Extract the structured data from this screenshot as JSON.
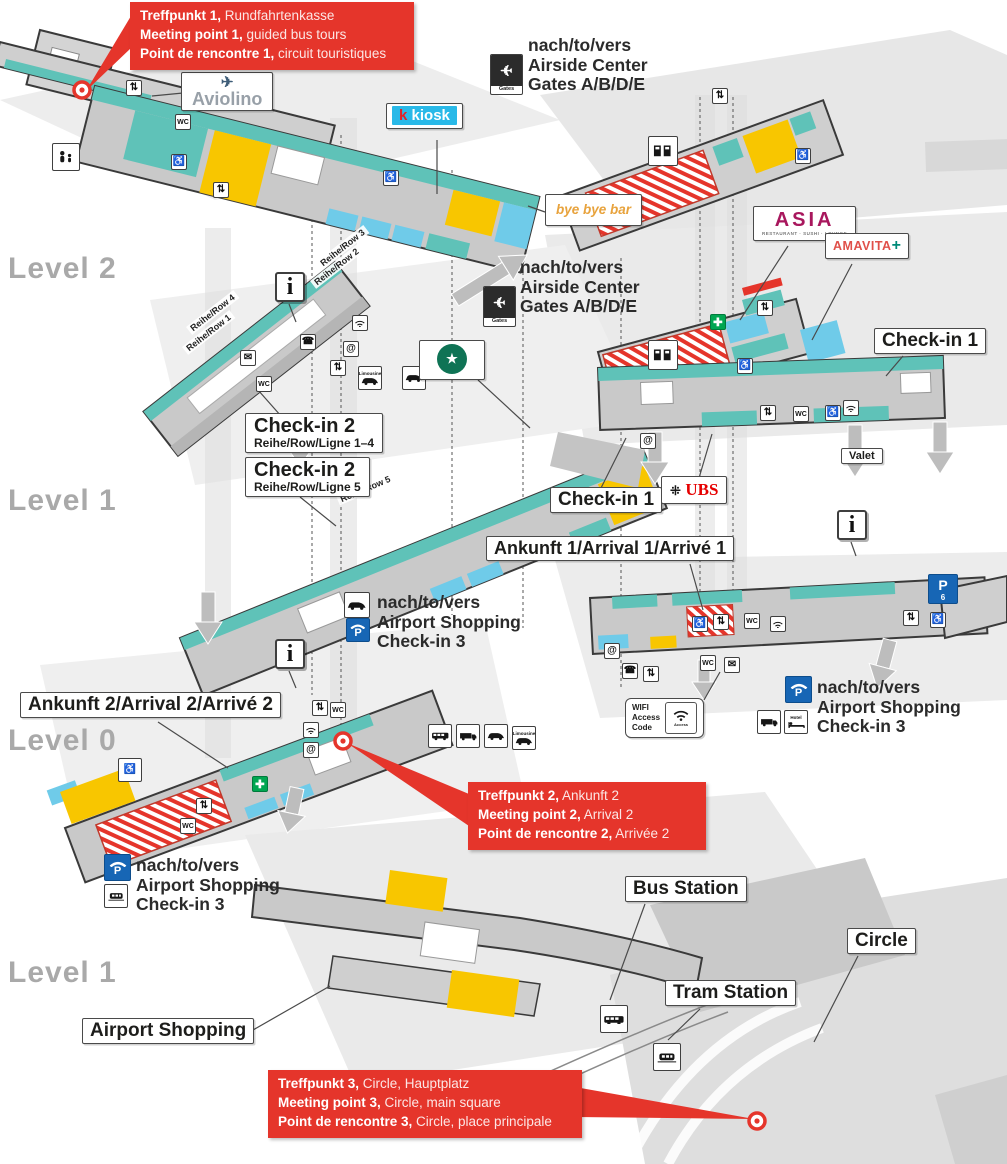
{
  "levels": {
    "l2": "Level 2",
    "l1_mid": "Level 1",
    "l0": "Level 0",
    "l1_bottom": "Level 1"
  },
  "meeting_points": [
    {
      "de_b": "Treffpunkt 1,",
      "de": " Rundfahrtenkasse",
      "en_b": "Meeting point 1,",
      "en": " guided bus tours",
      "fr_b": "Point de rencontre 1,",
      "fr": " circuit touristiques"
    },
    {
      "de_b": "Treffpunkt 2,",
      "de": " Ankunft 2",
      "en_b": "Meeting point 2,",
      "en": " Arrival 2",
      "fr_b": "Point de rencontre 2,",
      "fr": " Arrivée 2"
    },
    {
      "de_b": "Treffpunkt 3,",
      "de": " Circle, Hauptplatz",
      "en_b": "Meeting point 3,",
      "en": " Circle, main square",
      "fr_b": "Point de rencontre 3,",
      "fr": " Circle, place principale"
    }
  ],
  "directions": {
    "to": "nach/to/vers",
    "airside": "Airside Center",
    "gates": "Gates A/B/D/E",
    "shopping": "Airport Shopping",
    "checkin3": "Check-in 3"
  },
  "callouts": {
    "aviolino": "Aviolino",
    "kiosk_k": "k",
    "kiosk_rest": "kiosk",
    "bye_bye_bar": "bye bye bar",
    "asia": "ASIA",
    "asia_sub": "RESTAURANT · SUSHI · LOUNGE",
    "amavita": "AMAVITA",
    "amavita_cross": "+",
    "checkin2": "Check-in 2",
    "rows14": "Reihe/Row/Ligne 1–4",
    "row5": "Reihe/Row/Ligne 5",
    "checkin1": "Check-in 1",
    "ubs": "UBS",
    "ankunft1": "Ankunft 1/Arrival 1/Arrivé 1",
    "ankunft2": "Ankunft 2/Arrival 2/Arrivé 2",
    "valet": "Valet",
    "bus_station": "Bus Station",
    "tram_station": "Tram Station",
    "circle": "Circle",
    "airport_shopping": "Airport Shopping"
  },
  "wifi_box": {
    "line1": "WIFI",
    "line2": "Access",
    "line3": "Code",
    "mini": "Access"
  },
  "row_labels": {
    "r4": "Reihe/Row 4",
    "r1": "Reihe/Row 1",
    "r3": "Reihe/Row 3",
    "r2": "Reihe/Row 2",
    "r5": "Reihe/Row 5"
  },
  "colors": {
    "red": "#e5352b",
    "teal": "#5fc2b8",
    "yellow": "#f8c600",
    "blue": "#6fcbe9",
    "kiosk_cyan": "#29b9e8",
    "ubs_red": "#e60000",
    "asia_magenta": "#a8175d",
    "amavita_red": "#e0504a",
    "amavita_green": "#008a78",
    "starbucks_green": "#0f7355",
    "parking_blue": "#1766b5",
    "sos_green": "#00a651"
  },
  "map_icons": [
    {
      "x": 126,
      "y": 80,
      "t": "⇅",
      "n": "escalator-icon"
    },
    {
      "x": 175,
      "y": 114,
      "t": "WC",
      "n": "wc-icon"
    },
    {
      "x": 171,
      "y": 154,
      "t": "♿",
      "n": "accessible-icon"
    },
    {
      "x": 52,
      "y": 143,
      "t": "family",
      "n": "family-room-icon",
      "s": 28
    },
    {
      "x": 213,
      "y": 182,
      "t": "⇅",
      "n": "escalator-icon"
    },
    {
      "x": 383,
      "y": 170,
      "t": "♿",
      "n": "accessible-icon"
    },
    {
      "x": 352,
      "y": 315,
      "t": "wifi",
      "n": "wifi-icon"
    },
    {
      "x": 300,
      "y": 334,
      "t": "☎",
      "n": "phone-icon"
    },
    {
      "x": 343,
      "y": 341,
      "t": "@",
      "n": "internet-icon"
    },
    {
      "x": 240,
      "y": 350,
      "t": "✉",
      "n": "mail-icon"
    },
    {
      "x": 256,
      "y": 376,
      "t": "WC",
      "n": "wc-icon"
    },
    {
      "x": 330,
      "y": 360,
      "t": "⇅",
      "n": "escalator-icon"
    },
    {
      "x": 358,
      "y": 366,
      "t": "car",
      "n": "limousine-icon",
      "s": 24,
      "cap": "Limousine"
    },
    {
      "x": 402,
      "y": 366,
      "t": "car",
      "n": "taxi-icon",
      "s": 24
    },
    {
      "x": 648,
      "y": 136,
      "t": "vend",
      "n": "ticket-machines-icon",
      "s": 30
    },
    {
      "x": 712,
      "y": 88,
      "t": "⇅",
      "n": "escalator-icon"
    },
    {
      "x": 795,
      "y": 148,
      "t": "♿",
      "n": "accessible-icon"
    },
    {
      "x": 710,
      "y": 314,
      "t": "aid",
      "n": "sos-icon"
    },
    {
      "x": 648,
      "y": 340,
      "t": "vend",
      "n": "ticket-machines-icon",
      "s": 30
    },
    {
      "x": 737,
      "y": 358,
      "t": "♿",
      "n": "accessible-icon"
    },
    {
      "x": 757,
      "y": 300,
      "t": "⇅",
      "n": "escalator-icon"
    },
    {
      "x": 640,
      "y": 433,
      "t": "@",
      "n": "internet-icon"
    },
    {
      "x": 760,
      "y": 405,
      "t": "⇅",
      "n": "escalator-icon"
    },
    {
      "x": 793,
      "y": 406,
      "t": "WC",
      "n": "wc-icon"
    },
    {
      "x": 825,
      "y": 405,
      "t": "♿",
      "n": "accessible-icon"
    },
    {
      "x": 843,
      "y": 400,
      "t": "wifi",
      "n": "wifi-icon"
    },
    {
      "x": 692,
      "y": 616,
      "t": "♿",
      "n": "accessible-icon"
    },
    {
      "x": 713,
      "y": 614,
      "t": "⇅",
      "n": "escalator-icon"
    },
    {
      "x": 744,
      "y": 613,
      "t": "WC",
      "n": "wc-icon"
    },
    {
      "x": 770,
      "y": 616,
      "t": "wifi",
      "n": "wifi-icon"
    },
    {
      "x": 604,
      "y": 643,
      "t": "@",
      "n": "internet-icon"
    },
    {
      "x": 622,
      "y": 663,
      "t": "☎",
      "n": "phone-icon"
    },
    {
      "x": 643,
      "y": 666,
      "t": "⇅",
      "n": "escalator-icon"
    },
    {
      "x": 700,
      "y": 655,
      "t": "WC",
      "n": "wc-icon"
    },
    {
      "x": 724,
      "y": 657,
      "t": "✉",
      "n": "mail-icon"
    },
    {
      "x": 903,
      "y": 610,
      "t": "⇅",
      "n": "escalator-icon"
    },
    {
      "x": 930,
      "y": 612,
      "t": "♿",
      "n": "accessible-icon"
    },
    {
      "x": 303,
      "y": 722,
      "t": "wifi",
      "n": "wifi-icon"
    },
    {
      "x": 303,
      "y": 742,
      "t": "@",
      "n": "internet-icon"
    },
    {
      "x": 312,
      "y": 700,
      "t": "⇅",
      "n": "escalator-icon"
    },
    {
      "x": 330,
      "y": 702,
      "t": "WC",
      "n": "wc-icon"
    },
    {
      "x": 118,
      "y": 758,
      "t": "♿",
      "n": "accessible-icon",
      "s": 24
    },
    {
      "x": 180,
      "y": 818,
      "t": "WC",
      "n": "wc-icon"
    },
    {
      "x": 196,
      "y": 798,
      "t": "⇅",
      "n": "escalator-icon"
    },
    {
      "x": 252,
      "y": 776,
      "t": "aid",
      "n": "sos-icon"
    },
    {
      "x": 428,
      "y": 724,
      "t": "bus",
      "n": "shuttle-bus-icon",
      "s": 24
    },
    {
      "x": 456,
      "y": 724,
      "t": "truck",
      "n": "coach-icon",
      "s": 24
    },
    {
      "x": 484,
      "y": 724,
      "t": "car",
      "n": "taxi-icon",
      "s": 24
    },
    {
      "x": 512,
      "y": 726,
      "t": "car",
      "n": "limousine-icon",
      "s": 24,
      "cap": "Limousine"
    },
    {
      "x": 600,
      "y": 1005,
      "t": "bus",
      "n": "bus-station-icon",
      "s": 28
    },
    {
      "x": 653,
      "y": 1043,
      "t": "train",
      "n": "tram-station-icon",
      "s": 28
    },
    {
      "x": 490,
      "y": 54,
      "t": "gates",
      "n": "gates-plane-icon",
      "s": 33
    },
    {
      "x": 483,
      "y": 286,
      "t": "gates",
      "n": "gates-plane-icon",
      "s": 33
    },
    {
      "x": 344,
      "y": 592,
      "t": "car",
      "n": "car-icon",
      "s": 26
    },
    {
      "x": 346,
      "y": 618,
      "t": "pgarage",
      "n": "parking-garage-icon",
      "s": 24
    },
    {
      "x": 785,
      "y": 676,
      "t": "pgarage",
      "n": "parking-garage-icon",
      "s": 27
    },
    {
      "x": 757,
      "y": 710,
      "t": "truck",
      "n": "truck-icon",
      "s": 24
    },
    {
      "x": 784,
      "y": 710,
      "t": "hotel",
      "n": "hotel-icon",
      "s": 24,
      "cap": "Hotel"
    },
    {
      "x": 104,
      "y": 854,
      "t": "pgarage",
      "n": "parking-garage-icon",
      "s": 27
    },
    {
      "x": 104,
      "y": 884,
      "t": "train",
      "n": "train-icon",
      "s": 24
    },
    {
      "x": 275,
      "y": 272,
      "t": "info",
      "n": "information-icon",
      "s": 30
    },
    {
      "x": 837,
      "y": 510,
      "t": "info",
      "n": "information-icon",
      "s": 30
    },
    {
      "x": 275,
      "y": 639,
      "t": "info",
      "n": "information-icon",
      "s": 30
    },
    {
      "x": 928,
      "y": 574,
      "t": "p6",
      "n": "parking-p6-icon",
      "s": 30
    }
  ]
}
